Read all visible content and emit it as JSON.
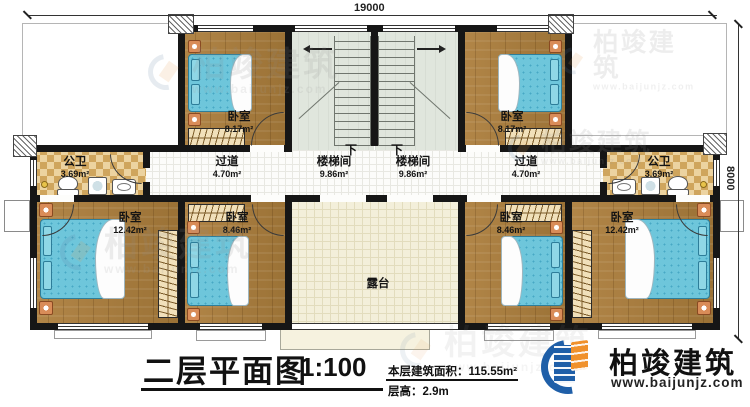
{
  "dimensions": {
    "top_label": "19000",
    "right_label": "8000"
  },
  "rooms": [
    {
      "id": "bedroom-top-left",
      "label": "卧室",
      "area": "8.17m²"
    },
    {
      "id": "stairwell-left",
      "label": "楼梯间",
      "area": "9.86m²",
      "direction": "下"
    },
    {
      "id": "stairwell-right",
      "label": "楼梯间",
      "area": "9.86m²",
      "direction": "下"
    },
    {
      "id": "bedroom-top-right",
      "label": "卧室",
      "area": "8.17m²"
    },
    {
      "id": "bath-left",
      "label": "公卫",
      "area": "3.69m²"
    },
    {
      "id": "corridor-left",
      "label": "过道",
      "area": "4.70m²"
    },
    {
      "id": "corridor-right",
      "label": "过道",
      "area": "4.70m²"
    },
    {
      "id": "bath-right",
      "label": "公卫",
      "area": "3.69m²"
    },
    {
      "id": "bedroom-outer-left",
      "label": "卧室",
      "area": "12.42m²"
    },
    {
      "id": "bedroom-inner-left",
      "label": "卧室",
      "area": "8.46m²"
    },
    {
      "id": "terrace",
      "label": "露台",
      "area": ""
    },
    {
      "id": "bedroom-inner-right",
      "label": "卧室",
      "area": "8.46m²"
    },
    {
      "id": "bedroom-outer-right",
      "label": "卧室",
      "area": "12.42m²"
    }
  ],
  "footer": {
    "title": "二层平面图",
    "scale": "1:100",
    "area_line": "本层建筑面积：115.55m²",
    "height_line": "层高：2.9m",
    "company": "柏竣建筑",
    "website": "www.baijunjz.com"
  },
  "watermark": {
    "company": "柏竣建筑",
    "website": "www.baijunjz.com"
  },
  "colors": {
    "wall": "#161616",
    "wood_floor": "#a97f43",
    "bed_blue": "#6ec6db",
    "bath_tile": "#cfa55d",
    "stair_floor": "#e0e6dd",
    "terrace_floor": "#f3efda",
    "logo_blue": "#1f5fa8",
    "logo_orange": "#f0912c"
  }
}
